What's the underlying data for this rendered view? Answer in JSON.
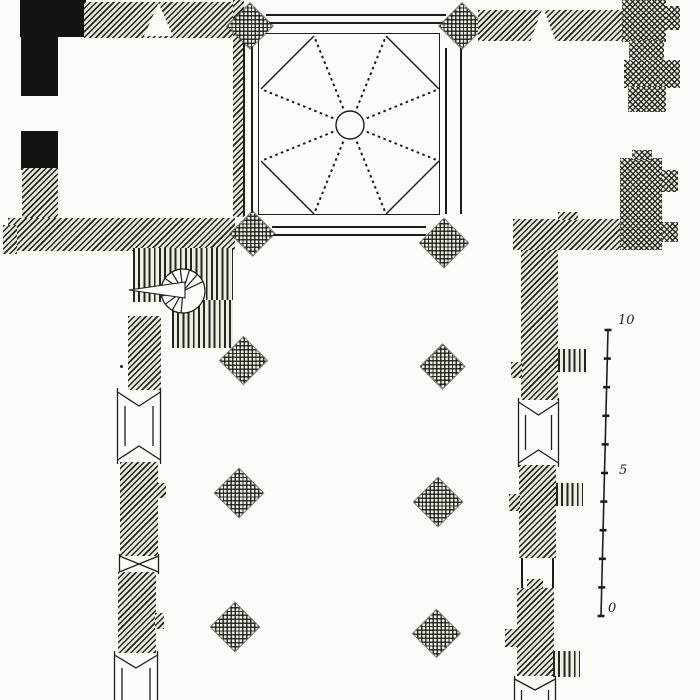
{
  "document": {
    "kind": "architectural floor plan engraving",
    "subject": "church ground plan: north-west tower room, crossing with octopartite rib vault, chapels, spiral stair, nave piers and aisle walls with window bays"
  },
  "palette": {
    "background": "#fcfbf8",
    "ink": "#1f1d19",
    "masonry_fill": "#eae7df",
    "solid_wall": "#151310"
  },
  "scale_bar": {
    "orientation": "vertical",
    "unit_labels": {
      "top": "10",
      "middle": "5",
      "bottom": "0"
    },
    "tick_count": 11
  },
  "icons": [
    {
      "name": "rib-vault-icon",
      "meaning": "crossing vault with dotted ribs, corner chords and central oculus"
    },
    {
      "name": "spiral-stair-icon",
      "meaning": "newel spiral staircase with entry arrow"
    },
    {
      "name": "portal-triangle-icon",
      "meaning": "door opening through wall"
    },
    {
      "name": "diamond-pier-icon",
      "meaning": "free-standing cross-hatched pier"
    },
    {
      "name": "window-bay-icon",
      "meaning": "window opening with splayed jambs (chevrons)"
    }
  ]
}
